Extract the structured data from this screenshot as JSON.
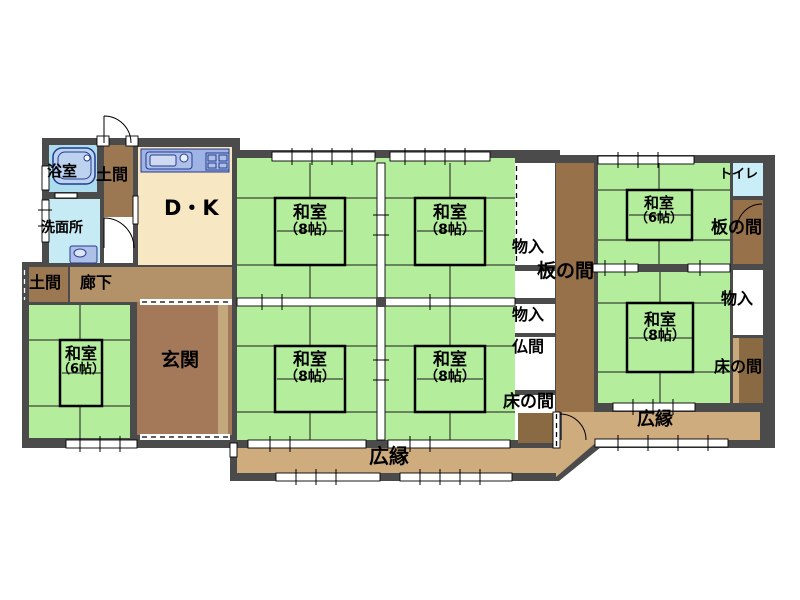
{
  "floorplan": {
    "type": "japanese-house-floorplan",
    "rooms": {
      "bath": {
        "label": "浴室"
      },
      "doma_top": {
        "label": "土間"
      },
      "dk": {
        "label": "D・K"
      },
      "senmenjo": {
        "label": "洗面所"
      },
      "doma_lower": {
        "label": "土間"
      },
      "rouka": {
        "label": "廊下"
      },
      "genkan": {
        "label": "玄関"
      },
      "washitsu6_left": {
        "label": "和室",
        "size": "（6帖）"
      },
      "washitsu8_nw": {
        "label": "和室",
        "size": "（8帖）"
      },
      "washitsu8_ne": {
        "label": "和室",
        "size": "（8帖）"
      },
      "washitsu8_sw": {
        "label": "和室",
        "size": "（8帖）"
      },
      "washitsu8_se": {
        "label": "和室",
        "size": "（8帖）"
      },
      "hiroen_south": {
        "label": "広縁"
      },
      "monoire_mid_upper": {
        "label": "物入"
      },
      "itanoma_mid": {
        "label": "板の間"
      },
      "monoire_mid_lower": {
        "label": "物入"
      },
      "butsuma": {
        "label": "仏間"
      },
      "tokonoma_mid": {
        "label": "床の間"
      },
      "washitsu6_right": {
        "label": "和室",
        "size": "（6帖）"
      },
      "toilet": {
        "label": "トイレ"
      },
      "itanoma_right": {
        "label": "板の間"
      },
      "monoire_right": {
        "label": "物入"
      },
      "washitsu8_right": {
        "label": "和室",
        "size": "（8帖）"
      },
      "tokonoma_right": {
        "label": "床の間"
      },
      "hiroen_east": {
        "label": "広縁"
      }
    },
    "colors": {
      "wall": "#4b4b4b",
      "tatami": "#b4ee9d",
      "veranda": "#ceac7e",
      "earth_floor": "#9c7852",
      "wood_strip": "#96714a",
      "entrance": "#a3795a",
      "corridor": "#b3926a",
      "dk_floor": "#f7e7c2",
      "bath": "#addcee",
      "washroom": "#c6ebf5",
      "toilet": "#c9eef7",
      "counter": "#9fb4e4",
      "tokonoma_dark": "#8a6a42",
      "tokonoma_light": "#c9a97b"
    }
  }
}
